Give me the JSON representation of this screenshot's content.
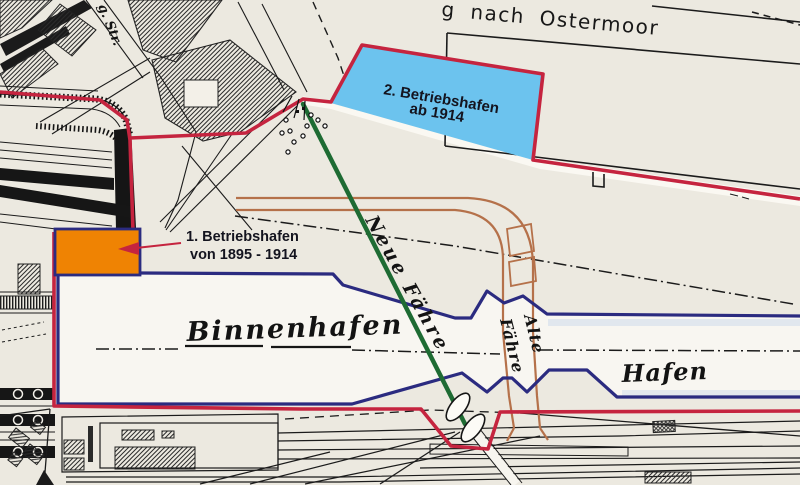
{
  "map": {
    "road_label": "g nach Ostermoor",
    "street_label": "g. Str.",
    "inner_harbor_label": "Binnenhafen",
    "harbor_label": "Hafen",
    "new_ferry_label": "Neue Fähre",
    "old_ferry_label": {
      "line1": "Alte",
      "line2": "Fähre"
    }
  },
  "annotations": {
    "first_port": {
      "line1": "1. Betriebshafen",
      "line2": "von 1895 - 1914"
    },
    "second_port": {
      "line1": "2. Betriebshafen",
      "line2": "ab 1914"
    }
  },
  "colors": {
    "paper": "#ece9e0",
    "boundary_red": "#c5243f",
    "harbor_navy": "#2b2b80",
    "basin_blue": "#6cc3ee",
    "port_orange": "#ef8303",
    "ferry_green": "#1e6b33",
    "road_brown": "#b5714a",
    "ink_black": "#1b1b1b"
  }
}
